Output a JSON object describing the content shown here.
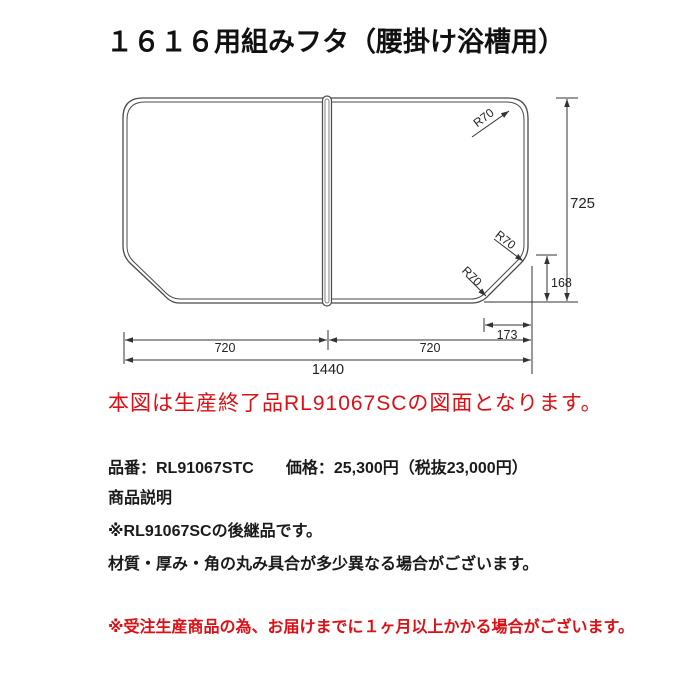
{
  "title": "１６１６用組みフタ（腰掛け浴槽用）",
  "diagram": {
    "note_red": "本図は生産終了品RL91067SCの図面となります。",
    "dims": {
      "total_height": "725",
      "chamfer_height": "168",
      "chamfer_width": "173",
      "panel_left_width": "720",
      "panel_right_width": "720",
      "total_width": "1440",
      "radius_top_right": "R70",
      "radius_chamfer_top": "R70",
      "radius_chamfer_bottom": "R70"
    }
  },
  "product": {
    "spec_line": "品番：RL91067STC　　価格：25,300円（税抜23,000円）",
    "desc_header": "商品説明",
    "desc1": "※RL91067SCの後継品です。",
    "desc2": "材質・厚み・角の丸み具合が多少異なる場合がございます。",
    "warning_red": "※受注生産商品の為、お届けまでに１ヶ月以上かかる場合がございます。"
  },
  "colors": {
    "red": "#dd0f14",
    "line": "#444444",
    "text": "#1a1a1a"
  }
}
